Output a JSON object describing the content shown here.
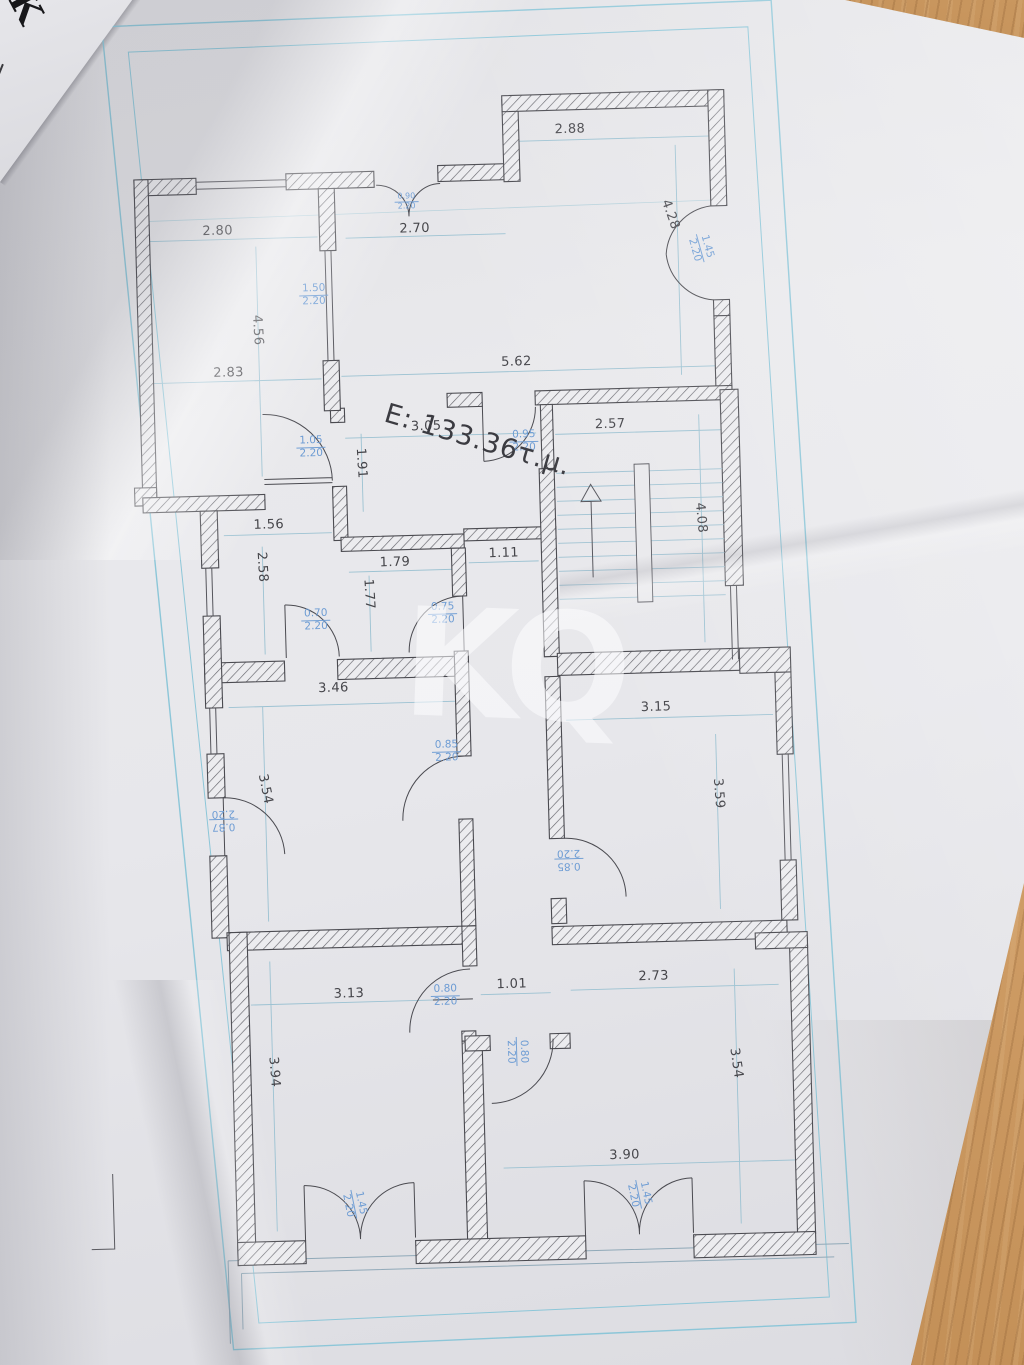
{
  "scene": {
    "corner_text": "Κ",
    "watermark": "KQ"
  },
  "plan": {
    "area_label": "Ε: 133.36τ.μ.",
    "dims": {
      "d1": "2.88",
      "d2": "2.80",
      "d3": "2.70",
      "d4": "4.28",
      "d5": "5.62",
      "d6": "2.83",
      "d7": "4.56",
      "d8": "3.05",
      "d9": "2.57",
      "d10": "1.91",
      "d11": "1.56",
      "d12": "2.58",
      "d13": "1.79",
      "d14": "1.11",
      "d15": "1.77",
      "d16": "4.08",
      "d17": "3.46",
      "d18": "3.15",
      "d19": "3.59",
      "d20": "3.54",
      "d21": "3.13",
      "d22": "1.01",
      "d23": "2.73",
      "d24": "3.94",
      "d25": "3.54",
      "d26": "3.90"
    },
    "doors": {
      "b1": {
        "w": "0.90",
        "h": "2.20"
      },
      "b2": {
        "w": "1.45",
        "h": "2.20"
      },
      "b3": {
        "w": "1.50",
        "h": "2.20"
      },
      "b4": {
        "w": "1.05",
        "h": "2.20"
      },
      "b5": {
        "w": "0.95",
        "h": "2.20"
      },
      "b6": {
        "w": "0.70",
        "h": "2.20"
      },
      "b7": {
        "w": "0.75",
        "h": "2.20"
      },
      "b8": {
        "w": "0.85",
        "h": "2.20"
      },
      "b9": {
        "w": "0.87",
        "h": "2.20"
      },
      "b10": {
        "w": "0.85",
        "h": "2.20"
      },
      "b11": {
        "w": "0.80",
        "h": "2.20"
      },
      "b12": {
        "w": "0.80",
        "h": "2.20"
      },
      "b13": {
        "w": "1.45",
        "h": "2.20"
      },
      "b14": {
        "w": "1.45",
        "h": "2.20"
      }
    },
    "colors": {
      "wall_line": "#4a4a50",
      "dim_cyan": "#9cc2d2",
      "door_label_blue": "#6d9cd4",
      "frame_cyan": "#8cc6d8",
      "wood": "#c08d55",
      "paper": "#e7e7eb"
    }
  }
}
